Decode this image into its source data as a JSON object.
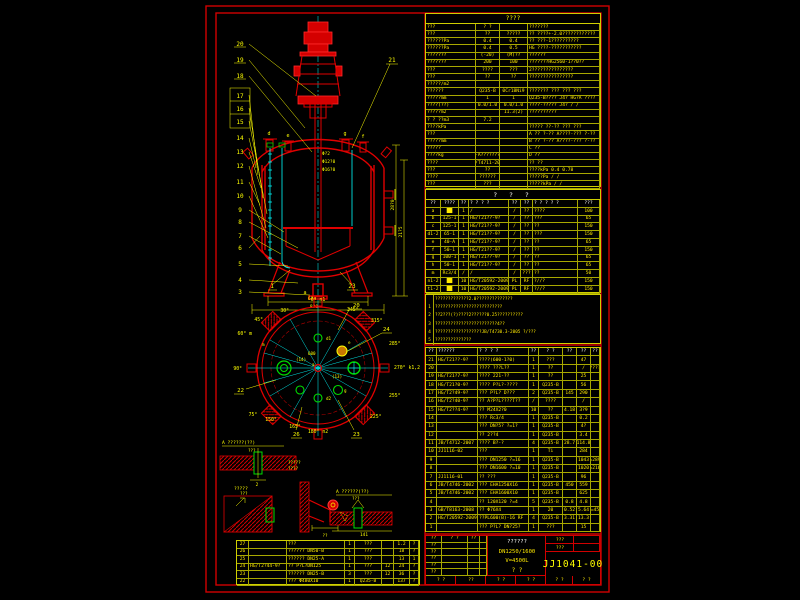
{
  "tech_table": {
    "title": "????",
    "rows": [
      [
        "???",
        "? ?",
        "",
        "???????"
      ],
      [
        "???",
        "??",
        "?????",
        "?? ????+-2.0????????????"
      ],
      [
        "??????Pa",
        "0.4",
        "0.4",
        "?? ???-1??????????"
      ],
      [
        "??????Pa",
        "0.4",
        "0.5",
        "HG ????-???????????"
      ],
      [
        "???????",
        "(-20)",
        "(M)??",
        "??????"
      ],
      [
        "???????",
        "200",
        "100",
        "???????HG2560-1??0??"
      ],
      [
        "???",
        "????",
        "???",
        "2???????????????"
      ],
      [
        "???",
        "??",
        "??",
        "????????????????"
      ],
      [
        "?????/m2",
        "",
        "",
        ""
      ],
      [
        "??????",
        "Q235-B",
        "0Cr18Ni9",
        "???????  ???  ???  ???"
      ],
      [
        "?????mm",
        "1",
        "1",
        "Q235-B????  J4?  HG?A  ????"
      ],
      [
        "????(??)",
        "0.0/1.0",
        "0.0/1.0",
        "????-?????  J4?  /  /"
      ],
      [
        "?????m2",
        "",
        "11.3(2)",
        "??????????"
      ],
      [
        "? ? ??m3",
        "7.2",
        "",
        ""
      ],
      [
        "????kPa",
        "",
        "",
        "?????  ??-??  ???  ???"
      ],
      [
        "???",
        "",
        "",
        "A ?? ?-?? A????-??? ?-??"
      ],
      [
        "?????mm",
        "",
        "",
        "B ?? ?-?? A????-??? ?-??"
      ],
      [
        "?????",
        "",
        "",
        "C ??"
      ],
      [
        "????kg",
        "-A???????",
        "",
        "D ??"
      ],
      [
        "????",
        "JB/T4711-2003",
        "",
        "??      ??"
      ],
      [
        "???",
        "??",
        "",
        "????kPa   0.4   0.78"
      ],
      [
        "????",
        "??????",
        "",
        "?????Pa    /     /"
      ],
      [
        "???",
        "???",
        "",
        "?????kPa   /     /"
      ]
    ]
  },
  "nozzle_table": {
    "title": "? ? ?",
    "headers": [
      "??",
      "????",
      "??",
      "? ? ? ?",
      "??",
      "??",
      "? ? ? ? ?",
      "???"
    ],
    "rows": [
      [
        "a",
        "██",
        "1",
        "/",
        "/",
        "??",
        "????",
        "100"
      ],
      [
        "b",
        "125-1",
        "1",
        "HG/T21??-9?",
        "/",
        "??",
        "???",
        "65"
      ],
      [
        "c",
        "125-1",
        "1",
        "HG/T21??-9?",
        "/",
        "??",
        "??",
        "150"
      ],
      [
        "d1-2",
        "65-1",
        "1",
        "HG/T21??-9?",
        "/",
        "??",
        "???",
        "150"
      ],
      [
        "e",
        "40-A",
        "1",
        "HG/T21??-9?",
        "/",
        "??",
        "??",
        "65"
      ],
      [
        "f",
        "50-1",
        "1",
        "HG/T21??-9?",
        "/",
        "??",
        "??",
        "150"
      ],
      [
        "g",
        "100-1",
        "1",
        "HG/T21??-9?",
        "/",
        "??",
        "??",
        "65"
      ],
      [
        "h",
        "50-1",
        "1",
        "HG/T21??-9?",
        "/",
        "??",
        "??",
        "65"
      ],
      [
        "m",
        "Rc3/4",
        "/",
        "/",
        "/",
        "???",
        "??",
        "50"
      ],
      [
        "n1-2",
        "██",
        "10",
        "HG/T20592-2009",
        "PL",
        "RF",
        "?//?",
        "150"
      ],
      [
        "t1-2",
        "██",
        "10",
        "HG/T20592-2009",
        "PL",
        "RF",
        "?//?",
        "150"
      ]
    ]
  },
  "notes": {
    "rows": [
      [
        "",
        "?????????????2.0??????????????"
      ],
      [
        "1",
        "??????????????????????????"
      ],
      [
        "2",
        "??2???(?)????2??????0.25??????????"
      ],
      [
        "3",
        "????????????????????????4??"
      ],
      [
        "4",
        "??????????????????JB/T4730.3-2005 ?/???"
      ],
      [
        "5",
        "??????????????"
      ]
    ]
  },
  "bom": {
    "headers": [
      "??",
      "??????",
      "? ? ? ?",
      "??",
      "? ?",
      "??",
      "??",
      "??"
    ],
    "rows": [
      [
        "21",
        "HG/T21??-9?",
        "????(600-1?0)",
        "1",
        "???",
        "",
        "47",
        ""
      ],
      [
        "20",
        "",
        "???? ???L??",
        "1",
        "??",
        "",
        "/",
        "????"
      ],
      [
        "19",
        "HG/T21?7-9?",
        "???? 221-??",
        "1",
        "??",
        "",
        "25",
        ""
      ],
      [
        "18",
        "HG/T21?0-9?",
        "???? P?L?-????",
        "1",
        "Q235-B",
        "",
        "56",
        ""
      ],
      [
        "17",
        "HG/T2?49-9?",
        "??? P?L? D???",
        "2",
        "Q235-B",
        "145",
        "290",
        ""
      ],
      [
        "16",
        "HG/T2?40-9?",
        "?? A?P?L????T??",
        "/",
        "????",
        "",
        "/",
        ""
      ],
      [
        "15",
        "HG/T2??4-9?",
        "?? M24X2?0",
        "10",
        "??",
        "4.18",
        "3?9",
        ""
      ],
      [
        "14",
        "",
        "??? Rc3/4",
        "1",
        "Q235-B",
        "",
        "0.2",
        ""
      ],
      [
        "13",
        "",
        "??? DN?5? ?=1?",
        "1",
        "Q235-B",
        "",
        "4?",
        ""
      ],
      [
        "12",
        "",
        "?? 2??4",
        "1",
        "Q235-B",
        "",
        "3.4",
        ""
      ],
      [
        "11",
        "JB/T4712-2007",
        "???? B?-?",
        "4",
        "Q235-B",
        "28.7",
        "114.8",
        ""
      ],
      [
        "10",
        "JJ1116-02",
        "???",
        "1",
        "Ti",
        "",
        "284",
        ""
      ],
      [
        "9",
        "",
        "??? DN1250 ?=16",
        "1",
        "Q235-B",
        "",
        "1043",
        "L=2890"
      ],
      [
        "8",
        "",
        "??? DN1600 ?=10",
        "1",
        "Q235-B",
        "",
        "1020",
        "L=2165"
      ],
      [
        "7",
        "JJ1116-01",
        "?? ???",
        "1",
        "Q235-B",
        "",
        "96",
        ""
      ],
      [
        "6",
        "JB/T4746-2002",
        "??? EHA1250X16",
        "1",
        "Q235-B",
        "450",
        "559",
        ""
      ],
      [
        "5",
        "JB/T4746-2002",
        "??? EHA1600X10",
        "1",
        "Q235-B",
        "",
        "625",
        ""
      ],
      [
        "4",
        "",
        "?? 120X120 ?=4",
        "5",
        "Q235-B",
        "0.8",
        "4.8",
        ""
      ],
      [
        "3",
        "GB/T8163-2008",
        "?? Φ76X4",
        "1",
        "20",
        "0.52",
        "5.64",
        "L=450"
      ],
      [
        "2",
        "HG/T20592-2009",
        "??PL600(B)-16 RF",
        "4",
        "Q235-B",
        "3.31",
        "13.3",
        ""
      ],
      [
        "1",
        "",
        "??? P?L? DN?25?",
        "1",
        "???",
        "",
        "15",
        ""
      ]
    ]
  },
  "bom_left": {
    "rows": [
      [
        "27",
        "",
        "???",
        "1",
        "???",
        "",
        "1.2",
        "?"
      ],
      [
        "26",
        "",
        "?????? DN50-B",
        "1",
        "???",
        "",
        "18",
        "?"
      ],
      [
        "25",
        "",
        "?????? DN25-A",
        "1",
        "???",
        "",
        "13",
        "1"
      ],
      [
        "24",
        "HG/T2?44-9?",
        "?? P?L?DN125",
        "1",
        "???",
        "12",
        "24",
        "?"
      ],
      [
        "23",
        "",
        "?????? DN25-B",
        "3",
        "???",
        "12",
        "36",
        "?"
      ],
      [
        "22",
        "",
        "??? Φ480X10",
        "1",
        "Q235-B",
        "",
        "137",
        "?"
      ]
    ]
  },
  "title_block": {
    "left_rows": [
      [
        "??",
        "? ?",
        "??",
        ""
      ],
      [
        "??",
        "",
        "",
        ""
      ],
      [
        "??",
        "",
        "",
        ""
      ],
      [
        "??",
        "",
        "",
        ""
      ],
      [
        "??",
        "",
        "",
        ""
      ],
      [
        "??",
        "",
        "",
        ""
      ]
    ],
    "project_line1": "??????",
    "spec": "DN1250/1600",
    "volume": "V=4500L",
    "stage": "?   ?",
    "label_top": "???",
    "label_mid": "???",
    "drawing_no": "JJ1041-00",
    "bottom_cells": [
      "? ?",
      "??",
      "? ?",
      "? ?"
    ],
    "bottom_right_left": "? ?",
    "bottom_right_right": "? ?"
  },
  "elevation": {
    "balloons_left": [
      "20",
      "19",
      "18",
      "17",
      "16",
      "15",
      "14",
      "13",
      "12",
      "11",
      "10",
      "9",
      "8",
      "7",
      "6",
      "5",
      "4",
      "3"
    ],
    "balloon_right": "21",
    "balloon_bottom_left": "1",
    "balloon_bottom_right": "23",
    "letters": {
      "d": "d",
      "e": "e",
      "g": "g",
      "f": "f",
      "a": "a"
    },
    "dims": {
      "phi_shaft": "Φ?2",
      "phi_inner": "Φ12?0",
      "phi_outer": "Φ16?0",
      "span": "6?0",
      "base": "8?0",
      "h_shell": "28?0",
      "h_jacket": "21?5"
    }
  },
  "plan": {
    "angle_labels": [
      "0° n1",
      "345°",
      "315°",
      "285°",
      "270° k1,2",
      "255°",
      "225°",
      "180° n2",
      "165°",
      "150°",
      "75°",
      "90°",
      "60° m",
      "45°",
      "30°"
    ],
    "callouts": [
      "20",
      "24",
      "22",
      "26",
      "23"
    ],
    "texts": {
      "t600": "600",
      "t13": "(13)",
      "t14": "(14)",
      "d1": "d1",
      "d2": "d2",
      "e": "e",
      "g": "g",
      "a": "a",
      "m": "m"
    }
  },
  "details": {
    "d1_title": "A ??????(??)",
    "d1_sub": "???",
    "d1_dim": "2",
    "d2_title": "?????",
    "d2_sub": "???",
    "d3_l1": "?????",
    "d3_l2": "????",
    "d3_dim": "??",
    "d4_title": "A ??????(??)",
    "d4_sub": "???",
    "d4_dim": "141"
  }
}
